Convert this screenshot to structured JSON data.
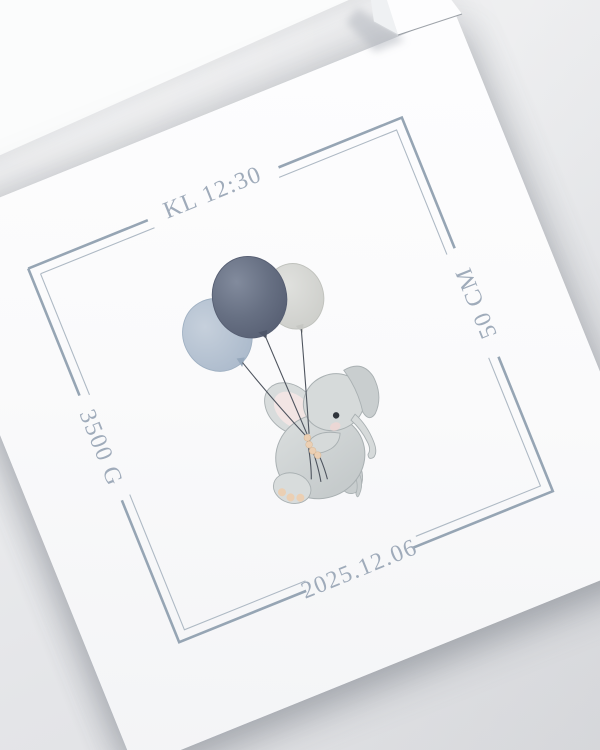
{
  "card": {
    "stats": {
      "time": "KL 12:30",
      "length": "50 CM",
      "weight": "3500 G",
      "date": "2025.12.06"
    },
    "illustration": "elephant-holding-three-balloons",
    "colors": {
      "accent_text": "#9fabba",
      "border_outer": "#96a5b4",
      "border_inner": "#aeb9c4",
      "balloon_dark": "#636c7f",
      "balloon_blue": "#b5c2d2",
      "balloon_gray": "#d9dad7",
      "string": "#4e545e",
      "elephant_body": "#d3d7d7",
      "ear_inner_pink": "#f2e5e4",
      "toe_pads": "#ebcfb3",
      "card_paper": "#fbfbfc",
      "photo_background": "#e8e9eb"
    }
  }
}
